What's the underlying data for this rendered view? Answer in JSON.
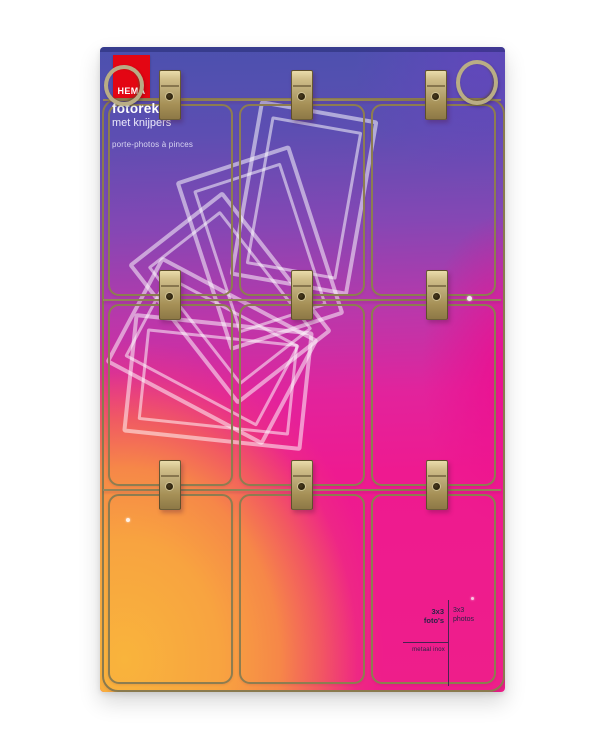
{
  "product": {
    "brand": "HEMA",
    "title": "fotorek",
    "subtitle": "met knijpers",
    "subtitle_fr": "porte-photos à pinces",
    "spec": {
      "nl_size": "3x3",
      "nl_unit": "foto's",
      "fr_size": "3x3",
      "fr_unit": "photos",
      "material": "metaal inox"
    }
  },
  "scene": {
    "grid": "3x3",
    "clip_count": 9,
    "ring_count": 2
  },
  "colors": {
    "background": "#ffffff",
    "brand_red": "#e30613",
    "card_top_blue": "#4b51ae",
    "card_violet": "#8547b4",
    "card_magenta": "#ee1a8e",
    "card_orange": "#f8a340",
    "card_yellow": "#f9b43c",
    "wire_brass": "#8a7a4e",
    "clip_brass": "#c3b184",
    "ring_metal": "#b9ad85",
    "spec_text": "#2b2347",
    "frame_outline_white": "rgba(255,255,255,0.52)"
  }
}
